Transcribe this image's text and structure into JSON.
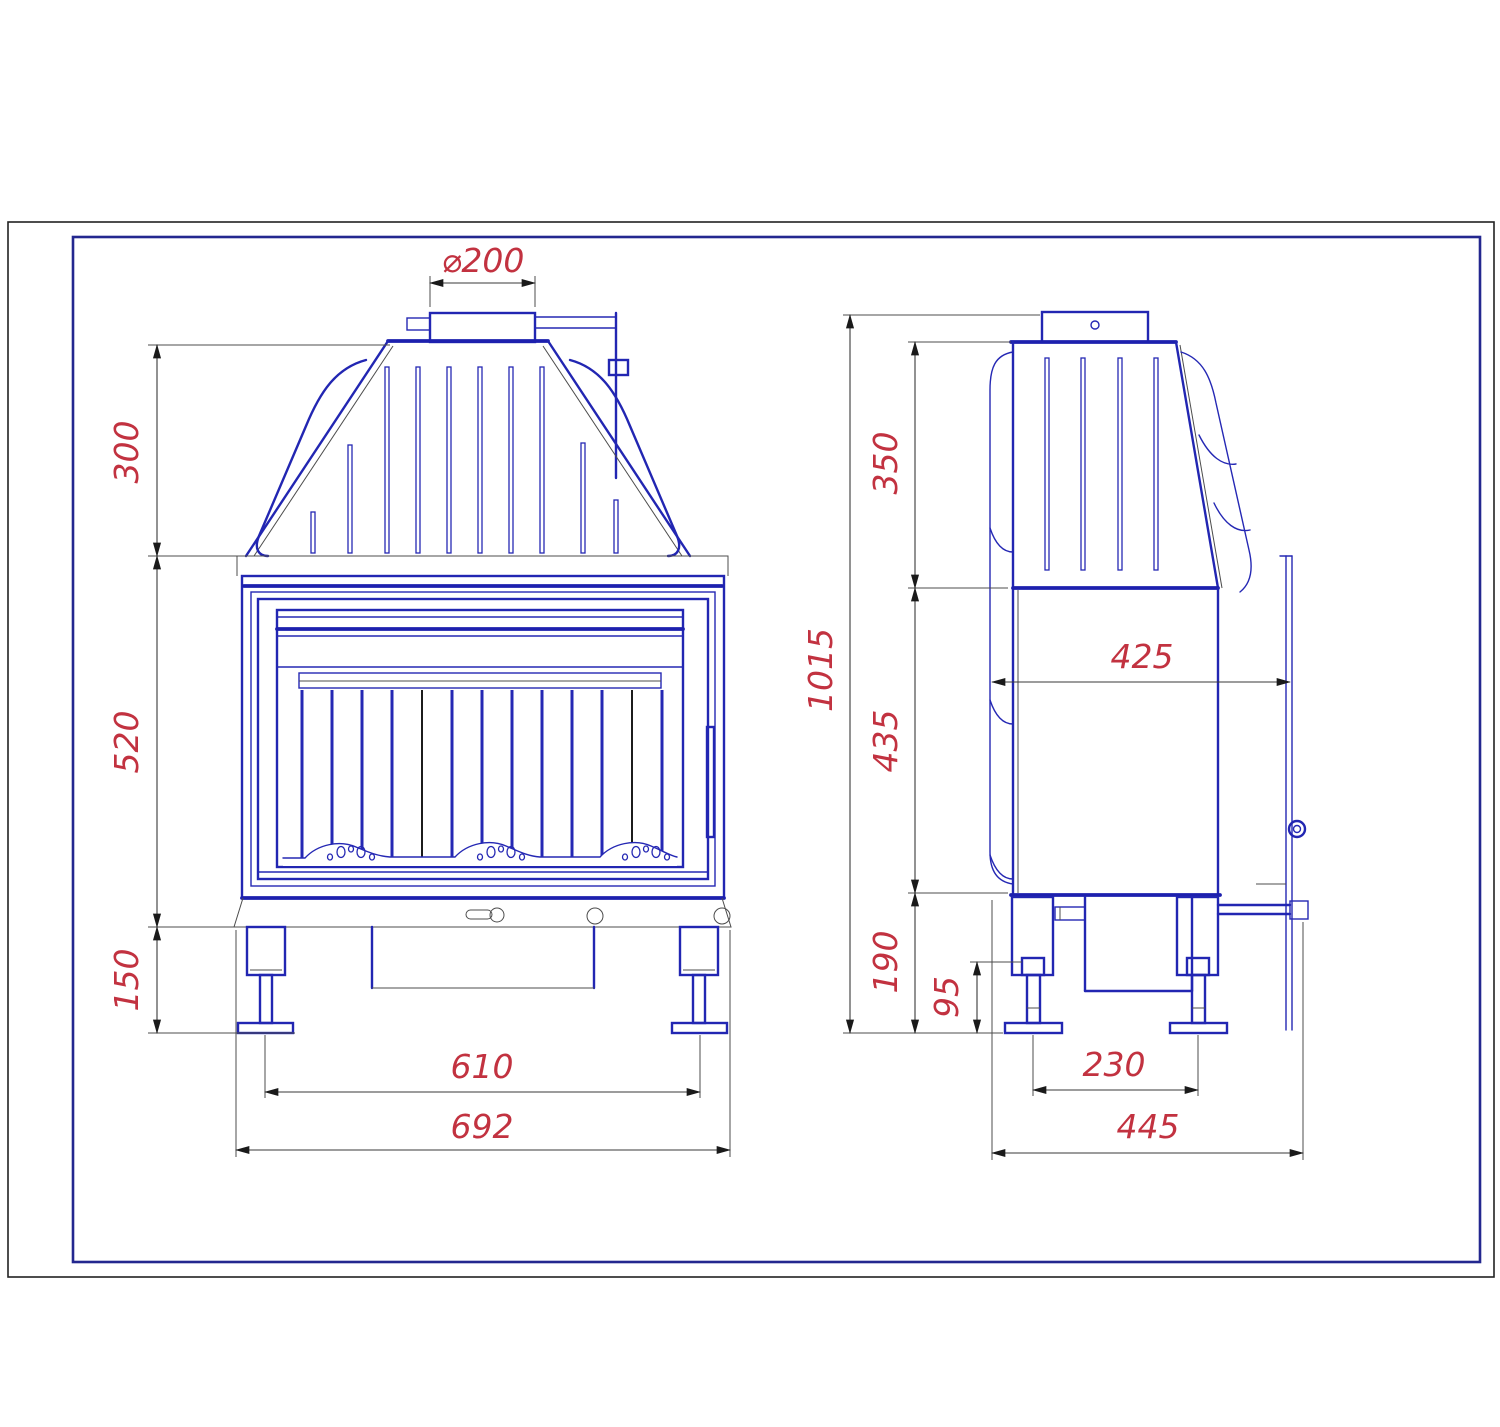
{
  "drawing": {
    "type": "technical-drawing",
    "subject": "fireplace insert, front and side orthographic views with dimensions",
    "colors": {
      "line_blue": "#2226b2",
      "dimension_text_red": "#c23240",
      "dimension_line_gray": "#3a3a3a",
      "outer_frame_black": "#222222",
      "inner_frame_blue": "#23278f",
      "background": "#ffffff"
    },
    "dimensions": {
      "front": {
        "flue_diameter": "⌀200",
        "hood_height": "300",
        "firebox_height": "520",
        "base_height": "150",
        "feet_spacing": "610",
        "overall_width": "692"
      },
      "side": {
        "hood_height": "350",
        "overall_height": "1015",
        "body_depth": "425",
        "firebox_height": "435",
        "base_height": "190",
        "foot_height": "95",
        "feet_spacing": "230",
        "overall_depth": "445"
      }
    }
  }
}
